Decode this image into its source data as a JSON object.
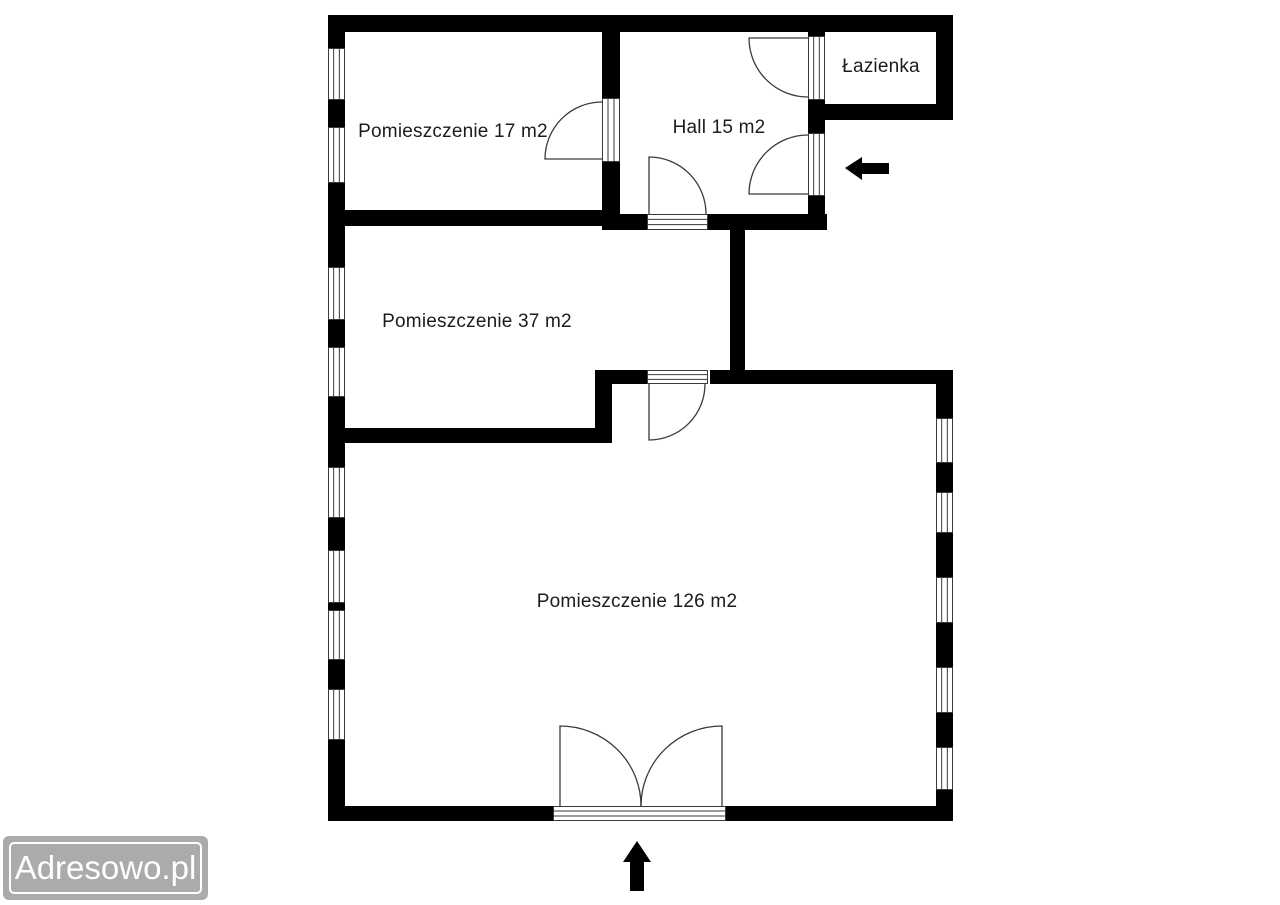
{
  "watermark": {
    "text": "Adresowo.pl",
    "bg_color": "#ababab",
    "text_color": "#ffffff"
  },
  "rooms": [
    {
      "id": "room-17",
      "label": "Pomieszczenie 17 m2",
      "cx": 453,
      "cy": 132
    },
    {
      "id": "hall",
      "label": "Hall 15 m2",
      "cx": 719,
      "cy": 128
    },
    {
      "id": "bathroom",
      "label": "Łazienka",
      "cx": 881,
      "cy": 67
    },
    {
      "id": "room-37",
      "label": "Pomieszczenie 37 m2",
      "cx": 477,
      "cy": 322
    },
    {
      "id": "room-126",
      "label": "Pomieszczenie 126 m2",
      "cx": 637,
      "cy": 602
    }
  ],
  "plan": {
    "wall_color": "#000000",
    "line_color": "#3a3a3a",
    "walls": [
      {
        "name": "wall-top",
        "x": 328,
        "y": 15,
        "w": 625,
        "h": 17
      },
      {
        "name": "wall-left",
        "x": 328,
        "y": 15,
        "w": 17,
        "h": 806
      },
      {
        "name": "wall-bottom",
        "x": 328,
        "y": 806,
        "w": 625,
        "h": 15
      },
      {
        "name": "wall-right",
        "x": 936,
        "y": 370,
        "w": 17,
        "h": 451
      },
      {
        "name": "wall-room126-top-right",
        "x": 710,
        "y": 370,
        "w": 243,
        "h": 14
      },
      {
        "name": "wall-room126-top-left",
        "x": 595,
        "y": 370,
        "w": 52,
        "h": 14
      },
      {
        "name": "wall-step-vertical",
        "x": 595,
        "y": 370,
        "w": 17,
        "h": 73
      },
      {
        "name": "wall-room37-bottom",
        "x": 328,
        "y": 428,
        "w": 284,
        "h": 15
      },
      {
        "name": "wall-room17-room37",
        "x": 328,
        "y": 210,
        "w": 292,
        "h": 16
      },
      {
        "name": "wall-room17-hall",
        "x": 602,
        "y": 15,
        "w": 18,
        "h": 211
      },
      {
        "name": "wall-hall-bottom",
        "x": 602,
        "y": 214,
        "w": 225,
        "h": 16
      },
      {
        "name": "wall-hall-room37-right",
        "x": 730,
        "y": 214,
        "w": 15,
        "h": 170
      },
      {
        "name": "wall-hall-right",
        "x": 808,
        "y": 15,
        "w": 17,
        "h": 215
      },
      {
        "name": "wall-bathroom-right",
        "x": 936,
        "y": 15,
        "w": 17,
        "h": 105
      },
      {
        "name": "wall-bathroom-bottom",
        "x": 808,
        "y": 104,
        "w": 145,
        "h": 16
      }
    ],
    "openings": [
      {
        "name": "window-left-1",
        "kind": "window",
        "orient": "v",
        "x": 328,
        "y": 48,
        "w": 17,
        "h": 52
      },
      {
        "name": "window-left-2",
        "kind": "window",
        "orient": "v",
        "x": 328,
        "y": 127,
        "w": 17,
        "h": 56
      },
      {
        "name": "window-left-3",
        "kind": "window",
        "orient": "v",
        "x": 328,
        "y": 267,
        "w": 17,
        "h": 53
      },
      {
        "name": "window-left-4",
        "kind": "window",
        "orient": "v",
        "x": 328,
        "y": 347,
        "w": 17,
        "h": 50
      },
      {
        "name": "window-left-5",
        "kind": "window",
        "orient": "v",
        "x": 328,
        "y": 467,
        "w": 17,
        "h": 51
      },
      {
        "name": "window-left-6",
        "kind": "window",
        "orient": "v",
        "x": 328,
        "y": 550,
        "w": 17,
        "h": 53
      },
      {
        "name": "window-left-7",
        "kind": "window",
        "orient": "v",
        "x": 328,
        "y": 610,
        "w": 17,
        "h": 50
      },
      {
        "name": "window-left-8",
        "kind": "window",
        "orient": "v",
        "x": 328,
        "y": 689,
        "w": 17,
        "h": 51
      },
      {
        "name": "window-right-1",
        "kind": "window",
        "orient": "v",
        "x": 936,
        "y": 418,
        "w": 17,
        "h": 45
      },
      {
        "name": "window-right-2",
        "kind": "window",
        "orient": "v",
        "x": 936,
        "y": 492,
        "w": 17,
        "h": 41
      },
      {
        "name": "window-right-3",
        "kind": "window",
        "orient": "v",
        "x": 936,
        "y": 577,
        "w": 17,
        "h": 46
      },
      {
        "name": "window-right-4",
        "kind": "window",
        "orient": "v",
        "x": 936,
        "y": 667,
        "w": 17,
        "h": 46
      },
      {
        "name": "window-right-5",
        "kind": "window",
        "orient": "v",
        "x": 936,
        "y": 747,
        "w": 17,
        "h": 43
      },
      {
        "name": "door-room17-hall-threshold",
        "kind": "door",
        "orient": "v",
        "x": 602,
        "y": 98,
        "w": 18,
        "h": 64
      },
      {
        "name": "door-hall-room37-threshold",
        "kind": "door",
        "orient": "h",
        "x": 647,
        "y": 214,
        "w": 61,
        "h": 16
      },
      {
        "name": "door-bathroom-threshold",
        "kind": "door",
        "orient": "v",
        "x": 808,
        "y": 36,
        "w": 17,
        "h": 64
      },
      {
        "name": "door-entrance-side-threshold",
        "kind": "door",
        "orient": "v",
        "x": 808,
        "y": 133,
        "w": 17,
        "h": 63
      },
      {
        "name": "door-room37-room126-threshold",
        "kind": "door",
        "orient": "h",
        "x": 647,
        "y": 370,
        "w": 61,
        "h": 14
      },
      {
        "name": "door-double-entrance-threshold",
        "kind": "door",
        "orient": "h",
        "x": 553,
        "y": 806,
        "w": 173,
        "h": 15
      }
    ],
    "door_arcs": [
      {
        "name": "door-arc-room17-hall",
        "path": "M 602 159 L 545 159 A 57 57 0 0 1 602 102"
      },
      {
        "name": "door-arc-hall-room37",
        "path": "M 649 214 L 649 157 A 57 57 0 0 1 706 214"
      },
      {
        "name": "door-arc-bathroom",
        "path": "M 808 38 L 749 38 A 59 59 0 0 0 808 97"
      },
      {
        "name": "door-arc-entrance-side",
        "path": "M 808 194 L 749 194 A 59 59 0 0 1 808 135"
      },
      {
        "name": "door-arc-room37-room126",
        "path": "M 649 384 L 649 440 A 56 56 0 0 0 705 384"
      },
      {
        "name": "door-arc-double-left",
        "path": "M 560 806 L 560 726 A 81 80 0 0 1 641 806"
      },
      {
        "name": "door-arc-double-right",
        "path": "M 722 806 L 722 726 A 81 80 0 0 0 641 806"
      }
    ],
    "arrows": [
      {
        "name": "entrance-arrow-side",
        "direction": "left",
        "points": "845,168 862,157 862,163 889,163 889,174 862,174 862,180"
      },
      {
        "name": "entrance-arrow-bottom",
        "direction": "up",
        "points": "637,841 651,862 644,862 644,891 630,891 630,862 623,862"
      }
    ]
  }
}
